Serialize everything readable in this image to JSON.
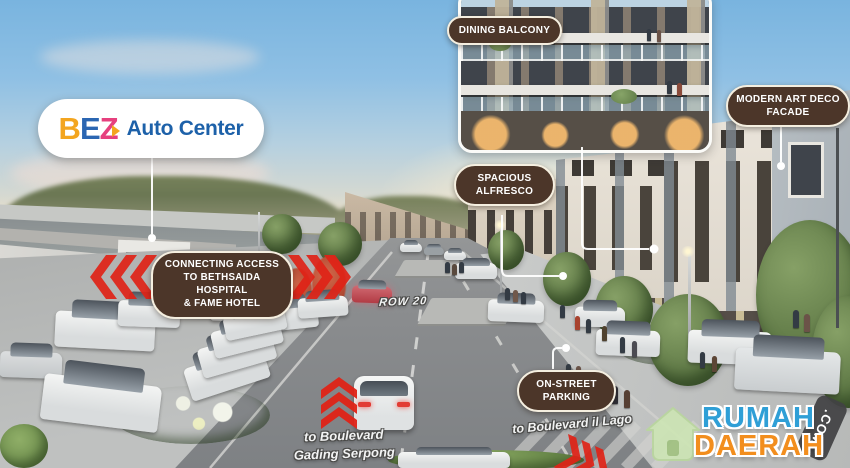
{
  "logo": {
    "b": "B",
    "e": "E",
    "z": "Z",
    "name": "Auto Center"
  },
  "callouts": {
    "dining": {
      "text": "DINING BALCONY"
    },
    "artdeco": {
      "l1": "MODERN ART DECO",
      "l2": "FACADE"
    },
    "alfresco": {
      "l1": "SPACIOUS",
      "l2": "ALFRESCO"
    },
    "connecting": {
      "l1": "CONNECTING ACCESS",
      "l2": "TO BETHSAIDA HOSPITAL",
      "l3": "& FAME HOTEL"
    },
    "parking": {
      "l1": "ON-STREET",
      "l2": "PARKING"
    }
  },
  "road_labels": {
    "row": "ROW 20",
    "gading1": "to Boulevard",
    "gading2": "Gading Serpong",
    "illago": "to Boulevard il Lago"
  },
  "watermark": {
    "word1": "RUMAH",
    "word2": "DAERAH",
    "suffix": ".COM"
  },
  "icons": {
    "watermark_house": "house-icon",
    "direction_arrows": "red-chevron-arrow-icon",
    "leader_marker": "leader-dot-icon"
  },
  "colors": {
    "callout_brown": "#4c3629",
    "callout_border": "#f5efe0",
    "arrow_red": "#e02317",
    "logo_blue": "#1d61a9",
    "logo_orange": "#f3a51f",
    "logo_pink": "#e6407e",
    "watermark_blue": "#2f9fd6",
    "watermark_orange": "#f28e1e"
  }
}
